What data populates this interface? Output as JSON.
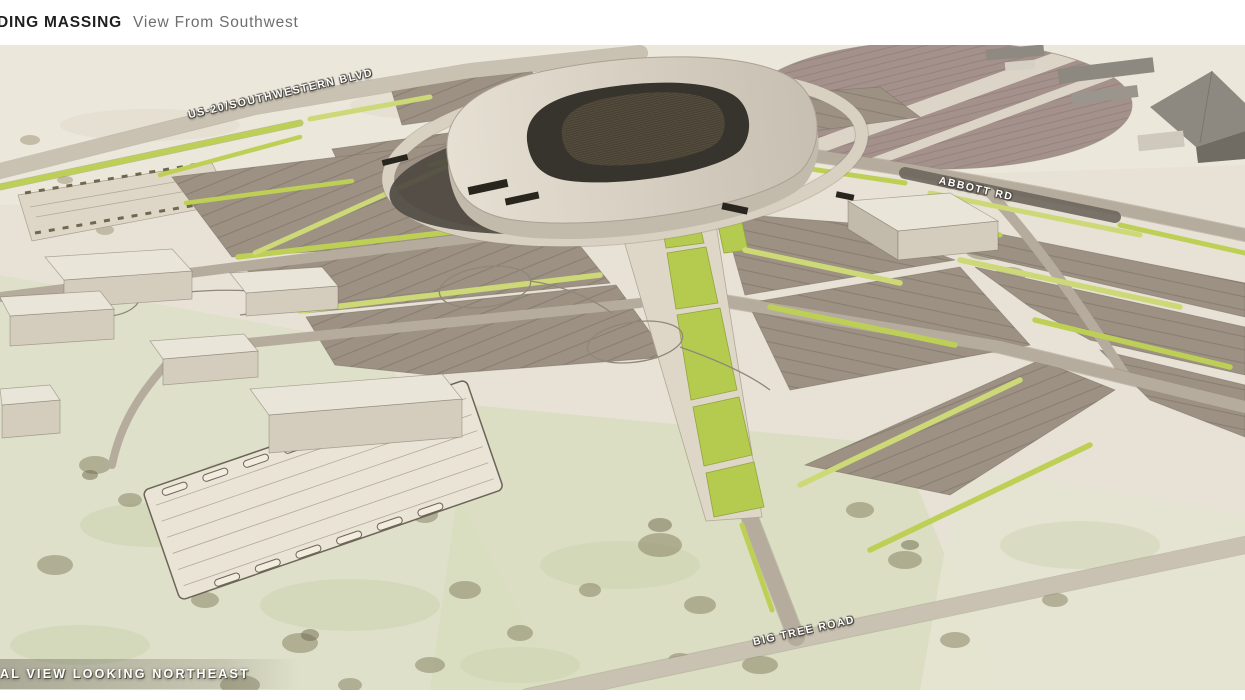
{
  "header": {
    "title_visible": "DING MASSING",
    "subtitle": "View From Southwest"
  },
  "map_labels": {
    "road_top": "US-20/SOUTHWESTERN BLVD",
    "road_right": "ABBOTT RD",
    "road_bottom": "BIG TREE ROAD"
  },
  "caption": {
    "text_visible": "AL VIEW LOOKING NORTHEAST"
  },
  "palette": {
    "ground": "#e7e2d5",
    "ground_green": "#dde0c8",
    "parking": "#9d9184",
    "parking_stripe": "#897e71",
    "green": "#bdd055",
    "green_alt": "#cdd877",
    "lawn": "#b4cb50",
    "road": "#b5ac9d",
    "road_light": "#c9c2b2",
    "road_dark": "#6b665d",
    "oval": "#a4918c",
    "oval_stripe": "#93817c",
    "shell_light": "#e6e0d3",
    "shell_dark": "#c7bfb1",
    "shell_face": "#c2baab",
    "bowl": "#37332d",
    "seat": "#554d3e",
    "shadow": "#4e4942",
    "building_top": "#eae5d9",
    "building_front": "#d4ccbd",
    "building_side": "#c2baaa",
    "building_gray": "#8e8980",
    "building_gray_dark": "#716c63",
    "field": "#eae4d6",
    "outline": "#6b6557",
    "label_text": "#ffffff",
    "label_shadow": "#4a463f",
    "title_text": "#1f1f1f",
    "subtitle_text": "#6e6e6e",
    "page_bg": "#ffffff"
  }
}
